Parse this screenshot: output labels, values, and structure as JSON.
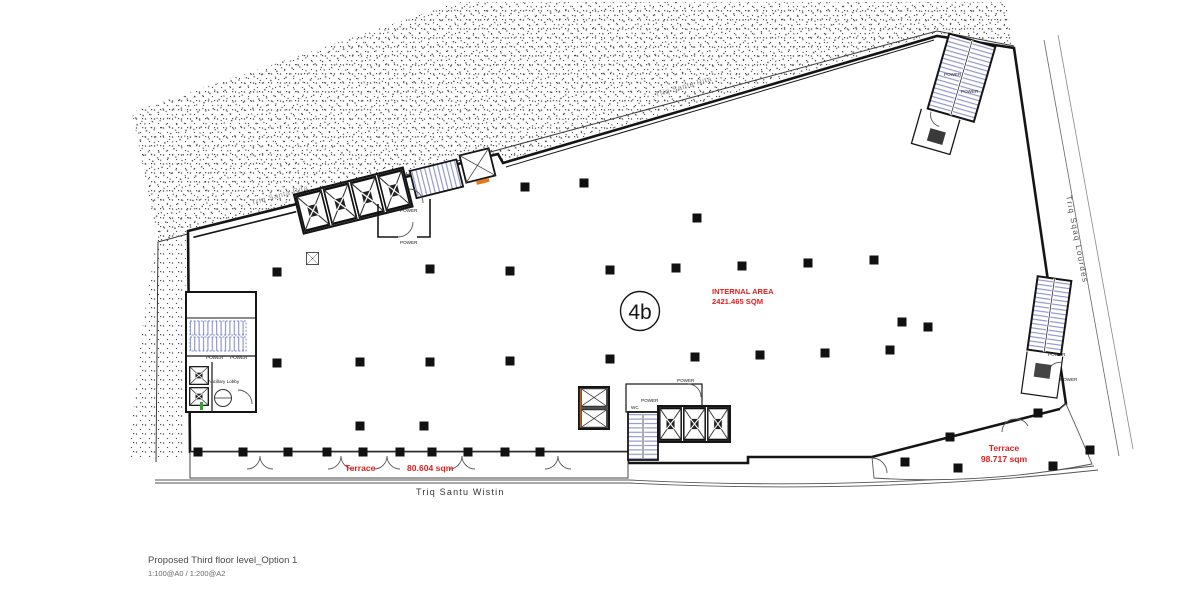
{
  "title_block": {
    "title": "Proposed Third floor level_Option 1",
    "scale": "1:100@A0 / 1:200@A2"
  },
  "labels": {
    "unit": "4b",
    "internal_area_1": "INTERNAL AREA",
    "internal_area_2": "2421.465 SQM",
    "terrace_south_name": "Terrace",
    "terrace_south_area": "80.604 sqm",
    "terrace_east_name": "Terrace",
    "terrace_east_area": "98.717 sqm"
  },
  "streets": {
    "south": "Triq  Santu  Wistin",
    "east": "Triq  Sqaq  Lourdes",
    "northwest": "Triq Santa Rita",
    "north": "Triq Santa Rita"
  },
  "rooms": {
    "power": "POWER",
    "ancillary_lobby": "Ancillary Lobby",
    "wc": "WC"
  },
  "colors": {
    "annotation_red": "#e02020",
    "wall": "#151515",
    "stair_blue": "#8a90c9",
    "accent_orange": "#e8781e",
    "accent_green": "#2fa52f",
    "stipple_gray": "#4c4c4c",
    "street_text": "#333333"
  },
  "plan": {
    "columns": [
      [
        525,
        187
      ],
      [
        584,
        183
      ],
      [
        697,
        218
      ],
      [
        277,
        272
      ],
      [
        430,
        269
      ],
      [
        510,
        271
      ],
      [
        610,
        270
      ],
      [
        676,
        268
      ],
      [
        742,
        266
      ],
      [
        808,
        263
      ],
      [
        874,
        260
      ],
      [
        902,
        322
      ],
      [
        928,
        327
      ],
      [
        277,
        363
      ],
      [
        360,
        362
      ],
      [
        430,
        362
      ],
      [
        510,
        361
      ],
      [
        610,
        359
      ],
      [
        695,
        357
      ],
      [
        760,
        355
      ],
      [
        825,
        353
      ],
      [
        890,
        350
      ],
      [
        360,
        426
      ],
      [
        424,
        426
      ],
      [
        198,
        452
      ],
      [
        243,
        452
      ],
      [
        288,
        452
      ],
      [
        327,
        452
      ],
      [
        363,
        452
      ],
      [
        400,
        452
      ],
      [
        432,
        452
      ],
      [
        468,
        452
      ],
      [
        505,
        452
      ],
      [
        540,
        452
      ],
      [
        905,
        462
      ],
      [
        958,
        468
      ],
      [
        1053,
        466
      ],
      [
        950,
        437
      ],
      [
        1038,
        413
      ],
      [
        1090,
        450
      ]
    ],
    "south_doors": [
      260,
      341,
      387,
      462,
      558
    ]
  }
}
